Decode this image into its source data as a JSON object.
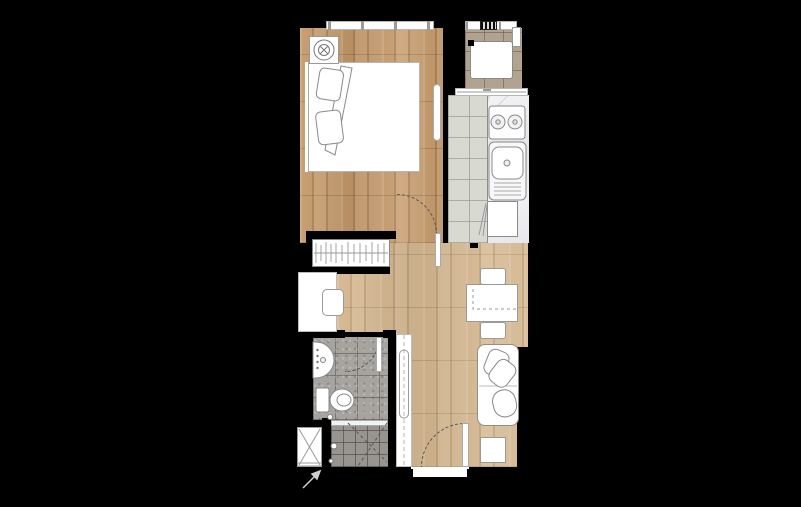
{
  "title": "studio-apartment-floor-plan",
  "canvas": {
    "width": 801,
    "height": 507
  },
  "colors": {
    "background": "#000000",
    "wood_bedroom": "#c39869",
    "wood_living": "#d2b48c",
    "balcony_tile": "#b2a391",
    "kitchen_tile": "#d8dad2",
    "bathroom_tile": "#a7a4a0",
    "shower_tile": "#98948f",
    "marble": "#ebebed",
    "fixture_fill": "#ffffff",
    "line": "#888888"
  },
  "rooms": [
    {
      "name": "bedroom",
      "floor": "wood"
    },
    {
      "name": "balcony",
      "floor": "beige-tile",
      "fixtures": [
        "washing-machine",
        "louver-window",
        "ledge"
      ]
    },
    {
      "name": "kitchen",
      "floor": "grey-tile",
      "fixtures": [
        "counter",
        "stove-2-burner",
        "sink",
        "refrigerator"
      ]
    },
    {
      "name": "hallway",
      "floor": "wood",
      "fixtures": [
        "wardrobe-hanging-rail",
        "desk",
        "desk-chair",
        "tall-cabinet"
      ]
    },
    {
      "name": "bathroom",
      "floor": "grey-tile",
      "fixtures": [
        "vanity-basin",
        "toilet",
        "shower",
        "service-shaft"
      ]
    },
    {
      "name": "living-dining",
      "floor": "wood",
      "fixtures": [
        "dining-table",
        "dining-chair",
        "dining-chair",
        "sofa",
        "side-table"
      ]
    }
  ],
  "doors": [
    "bedroom-swing-door",
    "bathroom-swing-door",
    "entry-swing-door",
    "balcony-sliding-door"
  ],
  "furniture_bedroom": [
    "double-bed",
    "pillows",
    "duvet-fold",
    "bedside-table",
    "plant",
    "ac-unit",
    "window-band"
  ]
}
